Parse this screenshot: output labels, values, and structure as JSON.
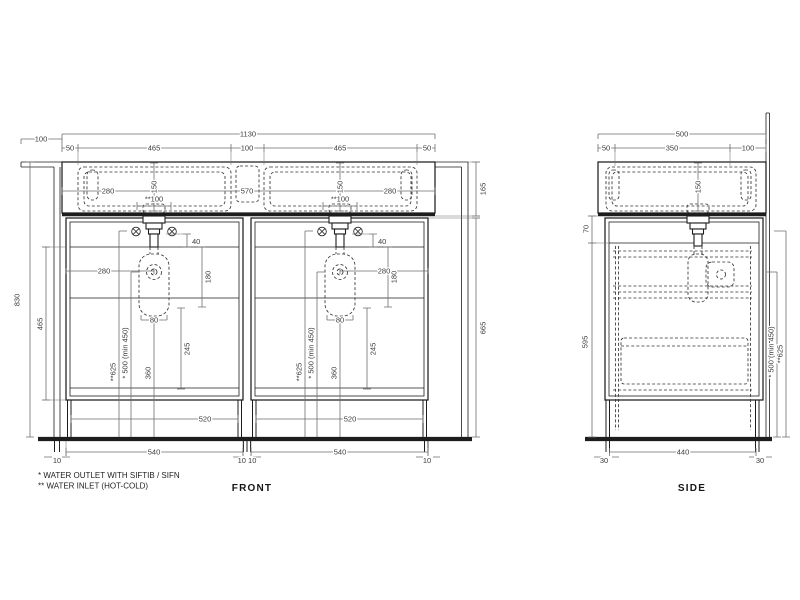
{
  "front": {
    "label": "FRONT",
    "dims": {
      "overhang": "100",
      "total_width": "1130",
      "edge": "50",
      "basin_width": "465",
      "basin_gap": "100",
      "basin_depth": "150",
      "drain_offset": "280",
      "drain_spacing": "570",
      "inlet_spacing": "**100",
      "height_total": "830",
      "counter_height": "165",
      "cabinet_height": "665",
      "door_height": "465",
      "top_gap": "40",
      "siphon_offset": "280",
      "siphon_height": "180",
      "trap_width": "80",
      "outlet_height": "* 500 (min 450)",
      "inlet_height": "**625",
      "trap_to_floor": "360",
      "lower_zone": "245",
      "clear_width": "520",
      "unit_width": "540",
      "panel": "10",
      "panel_pair": "10 10"
    }
  },
  "side": {
    "label": "SIDE",
    "dims": {
      "total_depth": "500",
      "front_edge": "50",
      "drain_depth": "350",
      "back_ledge": "100",
      "basin_depth": "150",
      "top_zone": "70",
      "body_height": "595",
      "outlet_height": "* 500 (min 450)",
      "inlet_height": "**625",
      "foot": "30",
      "base_depth": "440"
    }
  },
  "notes": {
    "line1": "*  WATER OUTLET WITH SIFTIB / SIFN",
    "line2": "** WATER INLET (HOT-COLD)"
  },
  "colors": {
    "line": "#1d1d1d",
    "dim": "#6f6f6f",
    "text": "#3c3c3c",
    "bg": "#ffffff"
  }
}
